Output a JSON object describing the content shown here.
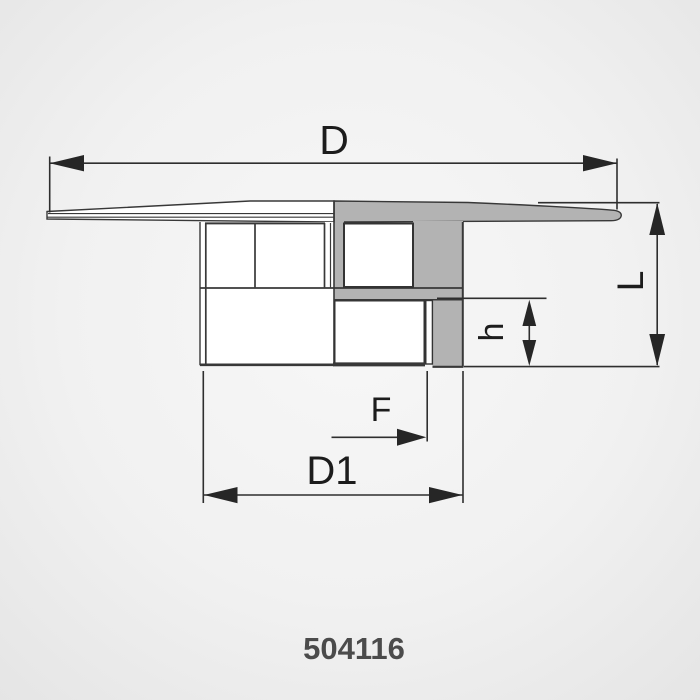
{
  "drawing": {
    "type": "technical-cross-section-diagram",
    "part_number": "504116",
    "labels": {
      "D": "D",
      "L": "L",
      "h": "h",
      "F": "F",
      "D1": "D1"
    },
    "colors": {
      "section_fill": "#b3b3b3",
      "body_fill": "#ffffff",
      "outline": "#383838",
      "dimension_line": "#2e2e2e",
      "label_text": "#1c1c1c",
      "part_number_text": "#4b4b4b",
      "background_center": "#f7f7f7",
      "background_edge": "#e5e5e5"
    }
  }
}
